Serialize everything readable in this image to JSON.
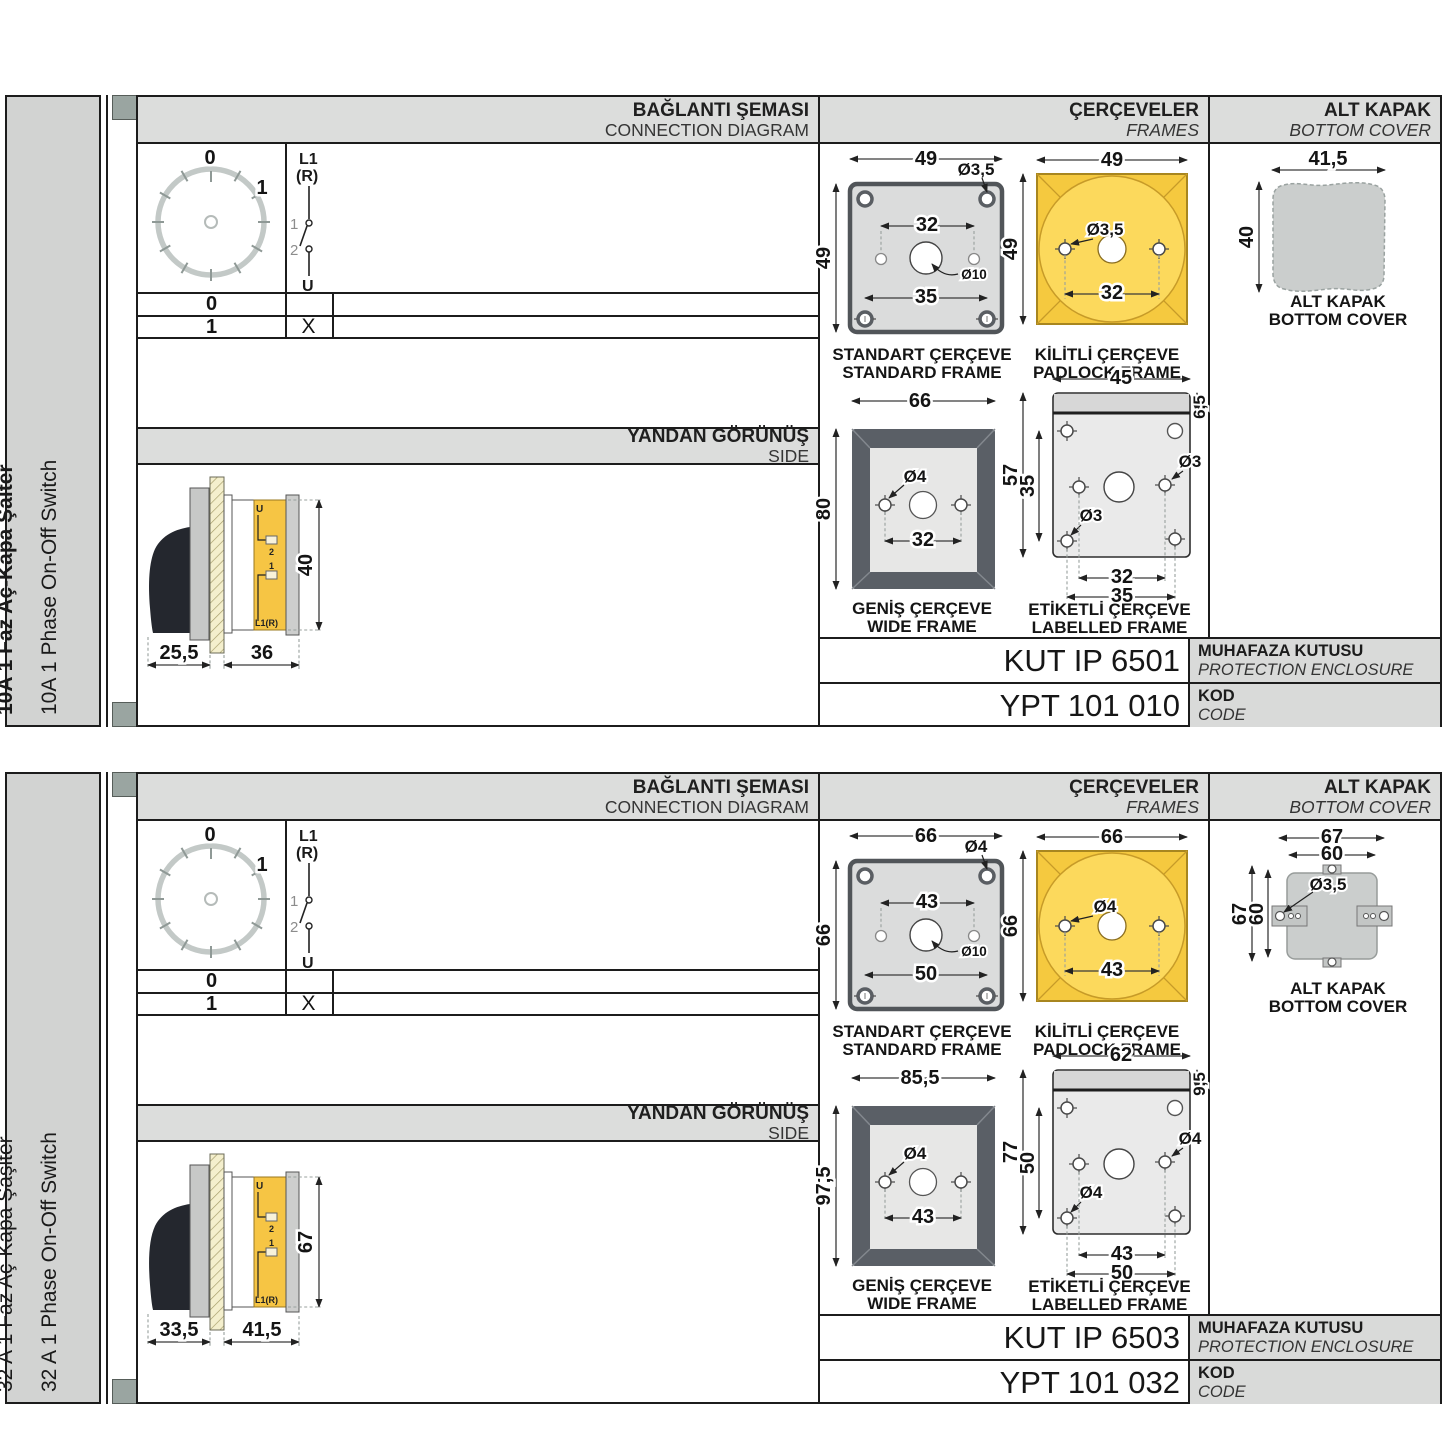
{
  "colors": {
    "accent_yellow": "#F5C93F",
    "panel_gray": "#DCDDDC",
    "frame_dark": "#5A5F66",
    "tab_green": "#9AA5A1",
    "cover_gray": "#CBCECD",
    "hatch_cream": "#F3EECA"
  },
  "sections": [
    {
      "sidebar": {
        "title_tr": "10A 1 Faz Aç-Kapa Şalter",
        "title_en": "10A 1 Phase On-Off Switch"
      },
      "headers": {
        "connection_tr": "BAĞLANTI ŞEMASI",
        "connection_en": "CONNECTION DIAGRAM",
        "frames_tr": "ÇERÇEVELER",
        "frames_en": "FRAMES",
        "cover_tr": "ALT KAPAK",
        "cover_en": "BOTTOM COVER",
        "side_tr": "YANDAN GÖRÜNÜŞ",
        "side_en": "SIDE"
      },
      "diagram": {
        "pos0": "0",
        "pos1": "1",
        "sw_l1": "L1",
        "sw_r": "(R)",
        "sw_c1": "1",
        "sw_c2": "2",
        "sw_u": "U",
        "row0_pos": "0",
        "row0_mark": "",
        "row1_pos": "1",
        "row1_mark": "X"
      },
      "side": {
        "dim_a": "25,5",
        "dim_b": "36",
        "dim_h": "40",
        "lbl_u": "U",
        "lbl_2": "2",
        "lbl_1": "1",
        "lbl_l1r": "L1(R)"
      },
      "frames": {
        "standard": {
          "cap_tr": "STANDART ÇERÇEVE",
          "cap_en": "STANDARD FRAME",
          "d_top": "49",
          "d_left": "49",
          "d_inner": "32",
          "d_bottom": "35",
          "hole": "Ø3,5",
          "center": "Ø10"
        },
        "padlock": {
          "cap_tr": "KİLİTLİ ÇERÇEVE",
          "cap_en": "PADLOCK FRAME",
          "d_top": "49",
          "d_left": "49",
          "d_inner": "32",
          "hole": "Ø3,5"
        },
        "wide": {
          "cap_tr": "GENİŞ ÇERÇEVE",
          "cap_en": "WIDE FRAME",
          "d_top": "66",
          "d_left": "80",
          "d_inner": "32",
          "hole": "Ø4"
        },
        "labelled": {
          "cap_tr": "ETİKETLİ ÇERÇEVE",
          "cap_en": "LABELLED FRAME",
          "d_top": "45",
          "d_right": "6,5",
          "d_left": "57",
          "d_left_in": "35",
          "d_bot_in": "32",
          "d_bot": "35",
          "hole_a": "Ø3",
          "hole_b": "Ø3"
        }
      },
      "cover": {
        "cap_tr": "ALT KAPAK",
        "cap_en": "BOTTOM COVER",
        "d_top": "41,5",
        "d_left": "40"
      },
      "codes": {
        "enclosure": "KUT IP 6501",
        "enclosure_tr": "MUHAFAZA KUTUSU",
        "enclosure_en": "PROTECTION ENCLOSURE",
        "code": "YPT 101 010",
        "code_tr": "KOD",
        "code_en": "CODE"
      }
    },
    {
      "sidebar": {
        "title_tr": "32 A 1 Faz Aç-Kapa Şaşlter",
        "title_en": "32 A 1 Phase On-Off Switch"
      },
      "headers": {
        "connection_tr": "BAĞLANTI ŞEMASI",
        "connection_en": "CONNECTION DIAGRAM",
        "frames_tr": "ÇERÇEVELER",
        "frames_en": "FRAMES",
        "cover_tr": "ALT KAPAK",
        "cover_en": "BOTTOM COVER",
        "side_tr": "YANDAN GÖRÜNÜŞ",
        "side_en": "SIDE"
      },
      "diagram": {
        "pos0": "0",
        "pos1": "1",
        "sw_l1": "L1",
        "sw_r": "(R)",
        "sw_c1": "1",
        "sw_c2": "2",
        "sw_u": "U",
        "row0_pos": "0",
        "row0_mark": "",
        "row1_pos": "1",
        "row1_mark": "X"
      },
      "side": {
        "dim_a": "33,5",
        "dim_b": "41,5",
        "dim_h": "67",
        "lbl_u": "U",
        "lbl_2": "2",
        "lbl_1": "1",
        "lbl_l1r": "L1(R)"
      },
      "frames": {
        "standard": {
          "cap_tr": "STANDART ÇERÇEVE",
          "cap_en": "STANDARD FRAME",
          "d_top": "66",
          "d_left": "66",
          "d_inner": "43",
          "d_bottom": "50",
          "hole": "Ø4",
          "center": "Ø10"
        },
        "padlock": {
          "cap_tr": "KİLİTLİ ÇERÇEVE",
          "cap_en": "PADLOCK FRAME",
          "d_top": "66",
          "d_left": "66",
          "d_inner": "43",
          "hole": "Ø4"
        },
        "wide": {
          "cap_tr": "GENİŞ ÇERÇEVE",
          "cap_en": "WIDE FRAME",
          "d_top": "85,5",
          "d_left": "97,5",
          "d_inner": "43",
          "hole": "Ø4"
        },
        "labelled": {
          "cap_tr": "ETİKETLİ ÇERÇEVE",
          "cap_en": "LABELLED FRAME",
          "d_top": "62",
          "d_right": "9,5",
          "d_left": "77",
          "d_left_in": "50",
          "d_bot_in": "43",
          "d_bot": "50",
          "hole_a": "Ø4",
          "hole_b": "Ø4"
        }
      },
      "cover": {
        "cap_tr": "ALT KAPAK",
        "cap_en": "BOTTOM COVER",
        "d_top_out": "67",
        "d_top_in": "60",
        "d_left_out": "67",
        "d_left_in": "60",
        "hole": "Ø3,5"
      },
      "codes": {
        "enclosure": "KUT IP 6503",
        "enclosure_tr": "MUHAFAZA KUTUSU",
        "enclosure_en": "PROTECTION ENCLOSURE",
        "code": "YPT 101 032",
        "code_tr": "KOD",
        "code_en": "CODE"
      }
    }
  ]
}
